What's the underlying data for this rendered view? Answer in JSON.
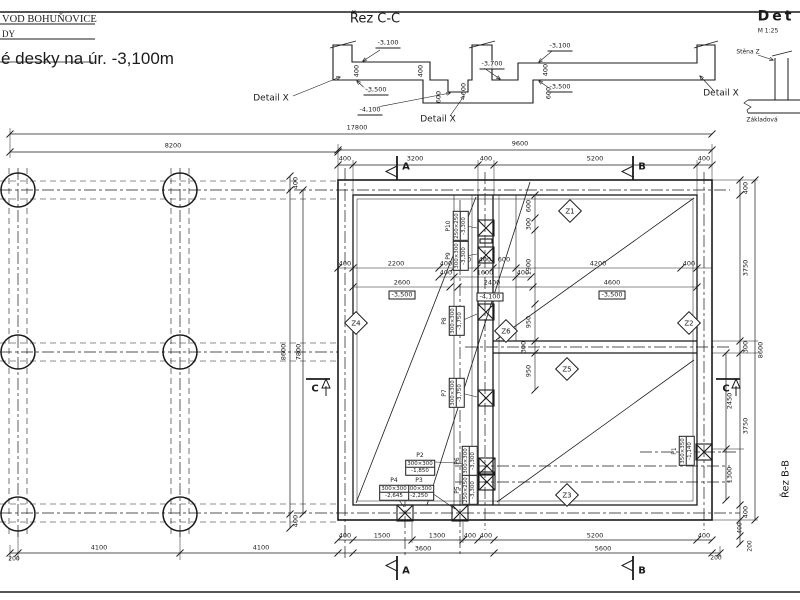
{
  "title_block": {
    "company": "VOD BOHUŇOVICE",
    "row2": "DY",
    "drawing_title": "é desky na úr. -3,100m"
  },
  "annotations": [
    {
      "name": "section-cc-title",
      "text": "Řez C-C",
      "x": 375,
      "y": 19,
      "cls": "sec-title"
    },
    {
      "name": "level-label",
      "text": "-3,100",
      "x": 388,
      "y": 44,
      "cls": "lvl"
    },
    {
      "name": "dim-label",
      "text": "400",
      "x": 357,
      "y": 71,
      "cls": "rot"
    },
    {
      "name": "dim-label",
      "text": "400",
      "x": 421,
      "y": 71,
      "cls": "rot"
    },
    {
      "name": "level-label",
      "text": "-3,500",
      "x": 376,
      "y": 91,
      "cls": "lvl"
    },
    {
      "name": "dim-label",
      "text": "600",
      "x": 439,
      "y": 97,
      "cls": "rot"
    },
    {
      "name": "dim-label",
      "text": "600",
      "x": 464,
      "y": 89,
      "cls": "rot"
    },
    {
      "name": "level-label",
      "text": "-4,100",
      "x": 370,
      "y": 111,
      "cls": "lvl"
    },
    {
      "name": "level-label",
      "text": "-3,700",
      "x": 492,
      "y": 65,
      "cls": "lvl"
    },
    {
      "name": "detail-callout",
      "text": "Detail X",
      "x": 271,
      "y": 99,
      "cls": "t9"
    },
    {
      "name": "detail-callout",
      "text": "Detail X",
      "x": 438,
      "y": 120,
      "cls": "t9"
    },
    {
      "name": "detail-callout",
      "text": "Detail X",
      "x": 721,
      "y": 94,
      "cls": "t9"
    },
    {
      "name": "level-label",
      "text": "-3,100",
      "x": 560,
      "y": 47,
      "cls": "lvl"
    },
    {
      "name": "dim-label",
      "text": "400",
      "x": 546,
      "y": 70,
      "cls": "rot"
    },
    {
      "name": "level-label",
      "text": "-3,500",
      "x": 560,
      "y": 88,
      "cls": "lvl"
    },
    {
      "name": "dim-label",
      "text": "600",
      "x": 549,
      "y": 93,
      "cls": "rot"
    },
    {
      "name": "detail-title",
      "text": "Det",
      "x": 776,
      "y": 17,
      "cls": "det-title"
    },
    {
      "name": "detail-scale",
      "text": "M 1:25",
      "x": 768,
      "y": 31,
      "cls": "tiny"
    },
    {
      "name": "wall-label",
      "text": "Stěna Z",
      "x": 748,
      "y": 52,
      "cls": "tiny"
    },
    {
      "name": "base-slab-label",
      "text": "Základová",
      "x": 762,
      "y": 120,
      "cls": "tiny"
    },
    {
      "name": "dim-label",
      "text": "17800",
      "x": 357,
      "y": 128
    },
    {
      "name": "dim-label",
      "text": "8200",
      "x": 173,
      "y": 146
    },
    {
      "name": "dim-label",
      "text": "9600",
      "x": 520,
      "y": 144
    },
    {
      "name": "dim-label",
      "text": "400",
      "x": 345,
      "y": 159
    },
    {
      "name": "dim-label",
      "text": "3200",
      "x": 415,
      "y": 159
    },
    {
      "name": "dim-label",
      "text": "400",
      "x": 486,
      "y": 159
    },
    {
      "name": "dim-label",
      "text": "5200",
      "x": 595,
      "y": 159
    },
    {
      "name": "dim-label",
      "text": "400",
      "x": 704,
      "y": 159
    },
    {
      "name": "section-marker-label",
      "text": "A",
      "x": 406,
      "y": 167,
      "cls": "marker"
    },
    {
      "name": "section-marker-label",
      "text": "B",
      "x": 642,
      "y": 167,
      "cls": "marker"
    },
    {
      "name": "dim-label",
      "text": "400",
      "x": 296,
      "y": 183,
      "cls": "rot"
    },
    {
      "name": "dim-label",
      "text": "8600",
      "x": 284,
      "y": 352,
      "cls": "rot"
    },
    {
      "name": "dim-label",
      "text": "7800",
      "x": 299,
      "y": 352,
      "cls": "rot"
    },
    {
      "name": "dim-label",
      "text": "400",
      "x": 296,
      "y": 521,
      "cls": "rot"
    },
    {
      "name": "dim-label",
      "text": "200",
      "x": 14,
      "y": 559,
      "cls": "tiny"
    },
    {
      "name": "dim-label",
      "text": "4100",
      "x": 99,
      "y": 548
    },
    {
      "name": "dim-label",
      "text": "4100",
      "x": 261,
      "y": 548
    },
    {
      "name": "dim-label",
      "text": "400",
      "x": 345,
      "y": 264
    },
    {
      "name": "dim-label",
      "text": "2200",
      "x": 396,
      "y": 264
    },
    {
      "name": "dim-label",
      "text": "400",
      "x": 446,
      "y": 264
    },
    {
      "name": "dim-label",
      "text": "600",
      "x": 465,
      "y": 260
    },
    {
      "name": "dim-label",
      "text": "400",
      "x": 485,
      "y": 260
    },
    {
      "name": "dim-label",
      "text": "600",
      "x": 504,
      "y": 260
    },
    {
      "name": "dim-label",
      "text": "4200",
      "x": 598,
      "y": 264
    },
    {
      "name": "dim-label",
      "text": "400",
      "x": 689,
      "y": 264
    },
    {
      "name": "dim-label",
      "text": "400",
      "x": 446,
      "y": 273
    },
    {
      "name": "dim-label",
      "text": "1600",
      "x": 485,
      "y": 273
    },
    {
      "name": "dim-label",
      "text": "400",
      "x": 523,
      "y": 273
    },
    {
      "name": "dim-label",
      "text": "2600",
      "x": 402,
      "y": 283
    },
    {
      "name": "level-label",
      "text": "-3,500",
      "x": 402,
      "y": 295,
      "cls": "boxlvl"
    },
    {
      "name": "dim-label",
      "text": "2400",
      "x": 492,
      "y": 283
    },
    {
      "name": "level-label",
      "text": "-4,100",
      "x": 490,
      "y": 297,
      "cls": "boxlvl"
    },
    {
      "name": "dim-label",
      "text": "4600",
      "x": 612,
      "y": 283
    },
    {
      "name": "level-label",
      "text": "-3,500",
      "x": 612,
      "y": 295,
      "cls": "boxlvl"
    },
    {
      "name": "dim-label",
      "text": "600",
      "x": 529,
      "y": 206,
      "cls": "rot"
    },
    {
      "name": "dim-label",
      "text": "300",
      "x": 529,
      "y": 224,
      "cls": "rot"
    },
    {
      "name": "dim-label",
      "text": "1900",
      "x": 529,
      "y": 267,
      "cls": "rot"
    },
    {
      "name": "dim-label",
      "text": "950",
      "x": 529,
      "y": 322,
      "cls": "rot"
    },
    {
      "name": "dim-label",
      "text": "300",
      "x": 524,
      "y": 347,
      "cls": "rot"
    },
    {
      "name": "dim-label",
      "text": "950",
      "x": 529,
      "y": 371,
      "cls": "rot"
    },
    {
      "name": "dim-label",
      "text": "400",
      "x": 345,
      "y": 536
    },
    {
      "name": "dim-label",
      "text": "1500",
      "x": 382,
      "y": 536
    },
    {
      "name": "dim-label",
      "text": "1300",
      "x": 437,
      "y": 536
    },
    {
      "name": "dim-label",
      "text": "400",
      "x": 470,
      "y": 536
    },
    {
      "name": "dim-label",
      "text": "400",
      "x": 486,
      "y": 536
    },
    {
      "name": "dim-label",
      "text": "5200",
      "x": 595,
      "y": 536
    },
    {
      "name": "dim-label",
      "text": "400",
      "x": 704,
      "y": 536
    },
    {
      "name": "dim-label",
      "text": "3600",
      "x": 423,
      "y": 549
    },
    {
      "name": "dim-label",
      "text": "5600",
      "x": 603,
      "y": 549
    },
    {
      "name": "dim-label",
      "text": "200",
      "x": 716,
      "y": 558,
      "cls": "tiny"
    },
    {
      "name": "section-marker-label",
      "text": "A",
      "x": 406,
      "y": 571,
      "cls": "marker"
    },
    {
      "name": "section-marker-label",
      "text": "B",
      "x": 642,
      "y": 571,
      "cls": "marker"
    },
    {
      "name": "dim-label",
      "text": "400",
      "x": 746,
      "y": 188,
      "cls": "rot"
    },
    {
      "name": "dim-label",
      "text": "3750",
      "x": 746,
      "y": 268,
      "cls": "rot"
    },
    {
      "name": "dim-label",
      "text": "300",
      "x": 746,
      "y": 347,
      "cls": "rot"
    },
    {
      "name": "dim-label",
      "text": "3750",
      "x": 746,
      "y": 426,
      "cls": "rot"
    },
    {
      "name": "dim-label",
      "text": "400",
      "x": 746,
      "y": 512,
      "cls": "rot"
    },
    {
      "name": "dim-label",
      "text": "2450",
      "x": 730,
      "y": 401,
      "cls": "rot"
    },
    {
      "name": "dim-label",
      "text": "1300",
      "x": 730,
      "y": 475,
      "cls": "rot"
    },
    {
      "name": "dim-label",
      "text": "8600",
      "x": 761,
      "y": 350,
      "cls": "rot"
    },
    {
      "name": "dim-label",
      "text": "400",
      "x": 740,
      "y": 528,
      "cls": "rot tiny"
    },
    {
      "name": "dim-label",
      "text": "200",
      "x": 750,
      "y": 546,
      "cls": "rot tiny"
    },
    {
      "name": "section-bb-label",
      "text": "Řez B-B",
      "x": 786,
      "y": 479,
      "cls": "bb rot"
    },
    {
      "name": "section-marker-label",
      "text": "C",
      "x": 315,
      "y": 389,
      "cls": "marker"
    },
    {
      "name": "section-marker-label",
      "text": "C",
      "x": 726,
      "y": 389,
      "cls": "marker"
    }
  ],
  "zones": [
    {
      "label": "Z1",
      "x": 570,
      "y": 211
    },
    {
      "label": "Z2",
      "x": 689,
      "y": 323
    },
    {
      "label": "Z3",
      "x": 567,
      "y": 495
    },
    {
      "label": "Z4",
      "x": 356,
      "y": 323
    },
    {
      "label": "Z5",
      "x": 567,
      "y": 369
    },
    {
      "label": "Z6",
      "x": 506,
      "y": 331
    }
  ],
  "columns": [
    {
      "label": "P1",
      "size": "350×350",
      "level": "-1,140",
      "x": 683,
      "y": 451,
      "rot": true
    },
    {
      "label": "P2",
      "size": "300×300",
      "level": "-1,850",
      "x": 420,
      "y": 464,
      "rot": false
    },
    {
      "label": "P3",
      "size": "300×300",
      "level": "-2,250",
      "x": 419,
      "y": 489,
      "rot": false
    },
    {
      "label": "P4",
      "size": "300×300",
      "level": "-2,645",
      "x": 394,
      "y": 489,
      "rot": false
    },
    {
      "label": "P5",
      "size": "250×250",
      "level": "-3,300",
      "x": 466,
      "y": 490,
      "rot": true
    },
    {
      "label": "P6",
      "size": "300×300",
      "level": "-3,300",
      "x": 466,
      "y": 461,
      "rot": true
    },
    {
      "label": "P7",
      "size": "300×300",
      "level": "-3,750",
      "x": 453,
      "y": 393,
      "rot": true
    },
    {
      "label": "P8",
      "size": "300×300",
      "level": "-3,750",
      "x": 453,
      "y": 321,
      "rot": true
    },
    {
      "label": "P9",
      "size": "300×300",
      "level": "-3,300",
      "x": 457,
      "y": 256,
      "rot": true
    },
    {
      "label": "P10",
      "size": "250×250",
      "level": "-3,300",
      "x": 457,
      "y": 226,
      "rot": true
    }
  ]
}
